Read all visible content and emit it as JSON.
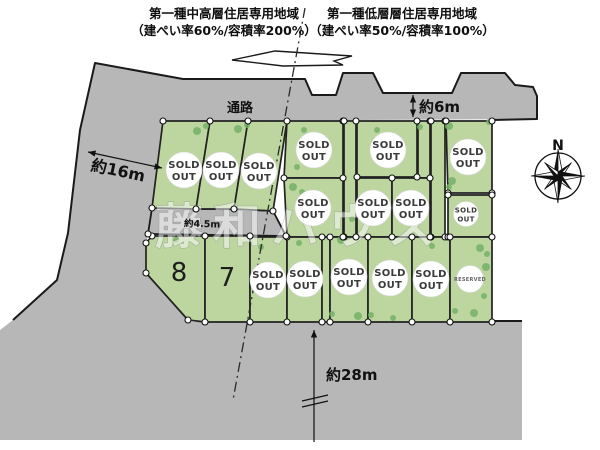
{
  "page": {
    "width": 600,
    "height": 450,
    "bg": "#ffffff"
  },
  "colors": {
    "road": "#b7b7b7",
    "lot": "#bdd6a0",
    "lot_edge": "#222222",
    "tree": "#74b267",
    "node_fill": "#ffffff",
    "node_edge": "#111111",
    "text": "#111111",
    "badge_fill": "#ffffff",
    "badge_text": "#3a3a3a",
    "reserved_text": "#666666",
    "watermark_fill": "#ffffff",
    "watermark_edge": "#7d828c",
    "dash": "#2a2a2a"
  },
  "zoning": {
    "left": {
      "line1": "第一種中高層住居専用地域",
      "line2": "（建ぺい率60%/容積率200%）"
    },
    "right": {
      "line1": "第一種低層層住居専用地域",
      "line2": "（建ぺい率50%/容積率100%）"
    },
    "boundary_line": {
      "x1": 305,
      "y1": 8,
      "x2": 233,
      "y2": 400
    }
  },
  "map": {
    "gray_area": [
      [
        95,
        63
      ],
      [
        183,
        79
      ],
      [
        305,
        79
      ],
      [
        312,
        95
      ],
      [
        336,
        95
      ],
      [
        343,
        73
      ],
      [
        373,
        73
      ],
      [
        383,
        93
      ],
      [
        452,
        93
      ],
      [
        461,
        73
      ],
      [
        505,
        73
      ],
      [
        515,
        85
      ],
      [
        533,
        87
      ],
      [
        537,
        96
      ],
      [
        537,
        119
      ],
      [
        163,
        121
      ],
      [
        152,
        208
      ],
      [
        148,
        234
      ],
      [
        146,
        243
      ],
      [
        146,
        273
      ],
      [
        188,
        320
      ],
      [
        188,
        322
      ],
      [
        492,
        322
      ],
      [
        522,
        322
      ],
      [
        522,
        440
      ],
      [
        0,
        440
      ],
      [
        0,
        330
      ],
      [
        13,
        320
      ],
      [
        57,
        280
      ],
      [
        68,
        233
      ],
      [
        80,
        130
      ]
    ],
    "road_mid": [
      [
        152,
        208
      ],
      [
        196,
        209
      ],
      [
        234,
        209
      ],
      [
        273,
        211
      ],
      [
        286,
        236
      ],
      [
        148,
        234
      ]
    ],
    "outlines": [
      "M13,320 L57,280 L68,233 L80,130 L95,63 L183,79 L305,79 L312,95 L336,95 L343,73 L373,73 L383,93 L452,93 L461,73 L505,73 L515,85 L533,87 L537,96 L537,119 L492,120",
      "M492,321 L522,321"
    ],
    "wedge": [
      [
        232,
        60
      ],
      [
        275,
        51
      ],
      [
        352,
        56
      ],
      [
        334,
        61
      ],
      [
        343,
        65
      ],
      [
        283,
        66
      ]
    ],
    "lots": [
      {
        "id": "u1",
        "points": [
          [
            163,
            121
          ],
          [
            210,
            121
          ],
          [
            196,
            209
          ],
          [
            152,
            208
          ]
        ],
        "badge": "sold",
        "badge_xy": [
          184,
          170
        ]
      },
      {
        "id": "u2",
        "points": [
          [
            210,
            121
          ],
          [
            248,
            121
          ],
          [
            234,
            209
          ],
          [
            196,
            209
          ]
        ],
        "badge": "sold",
        "badge_xy": [
          221,
          170
        ]
      },
      {
        "id": "u3",
        "points": [
          [
            248,
            121
          ],
          [
            287,
            121
          ],
          [
            273,
            211
          ],
          [
            234,
            209
          ]
        ],
        "badge": "sold",
        "badge_xy": [
          259,
          171
        ]
      },
      {
        "id": "a4",
        "points": [
          [
            287,
            121
          ],
          [
            343,
            121
          ],
          [
            343,
            178
          ],
          [
            284,
            178
          ]
        ],
        "badge": "sold",
        "badge_xy": [
          314,
          150
        ]
      },
      {
        "id": "p1",
        "points": [
          [
            344,
            121
          ],
          [
            356,
            121
          ],
          [
            356,
            237
          ],
          [
            344,
            237
          ]
        ]
      },
      {
        "id": "a5",
        "points": [
          [
            357,
            121
          ],
          [
            417,
            121
          ],
          [
            417,
            177
          ],
          [
            357,
            177
          ]
        ],
        "badge": "sold",
        "badge_xy": [
          388,
          150
        ]
      },
      {
        "id": "p2",
        "points": [
          [
            418,
            121
          ],
          [
            430,
            121
          ],
          [
            430,
            178
          ],
          [
            418,
            178
          ]
        ]
      },
      {
        "id": "p3",
        "points": [
          [
            431,
            121
          ],
          [
            445,
            121
          ],
          [
            445,
            237
          ],
          [
            431,
            237
          ]
        ]
      },
      {
        "id": "a6",
        "points": [
          [
            446,
            121
          ],
          [
            492,
            121
          ],
          [
            492,
            193
          ],
          [
            448,
            193
          ]
        ],
        "badge": "sold",
        "badge_xy": [
          468,
          157
        ]
      },
      {
        "id": "b1",
        "points": [
          [
            284,
            178
          ],
          [
            343,
            178
          ],
          [
            343,
            237
          ],
          [
            287,
            237
          ]
        ],
        "badge": "sold",
        "badge_xy": [
          313,
          208
        ]
      },
      {
        "id": "b2",
        "points": [
          [
            357,
            178
          ],
          [
            392,
            178
          ],
          [
            392,
            237
          ],
          [
            357,
            237
          ]
        ],
        "badge": "sold",
        "badge_xy": [
          373,
          208
        ]
      },
      {
        "id": "b3",
        "points": [
          [
            392,
            178
          ],
          [
            430,
            178
          ],
          [
            430,
            237
          ],
          [
            392,
            237
          ]
        ],
        "badge": "sold",
        "badge_xy": [
          411,
          208
        ]
      },
      {
        "id": "b4",
        "points": [
          [
            448,
            195
          ],
          [
            492,
            195
          ],
          [
            492,
            237
          ],
          [
            448,
            237
          ]
        ],
        "badge": "sold_small",
        "badge_xy": [
          466,
          214
        ]
      },
      {
        "id": "l8",
        "points": [
          [
            152,
            236
          ],
          [
            205,
            236
          ],
          [
            205,
            322
          ],
          [
            188,
            320
          ],
          [
            146,
            273
          ],
          [
            146,
            243
          ]
        ],
        "number": "8",
        "number_xy": [
          179,
          281
        ]
      },
      {
        "id": "l7",
        "points": [
          [
            205,
            236
          ],
          [
            250,
            236
          ],
          [
            250,
            322
          ],
          [
            205,
            322
          ]
        ],
        "number": "7",
        "number_xy": [
          227,
          286
        ]
      },
      {
        "id": "c1",
        "points": [
          [
            250,
            237
          ],
          [
            287,
            237
          ],
          [
            287,
            322
          ],
          [
            250,
            322
          ]
        ],
        "badge": "sold",
        "badge_xy": [
          268,
          280
        ]
      },
      {
        "id": "c2",
        "points": [
          [
            287,
            237
          ],
          [
            322,
            237
          ],
          [
            322,
            322
          ],
          [
            287,
            322
          ]
        ],
        "badge": "sold",
        "badge_xy": [
          305,
          279
        ]
      },
      {
        "id": "p4",
        "points": [
          [
            322,
            237
          ],
          [
            330,
            237
          ],
          [
            330,
            322
          ],
          [
            322,
            322
          ]
        ]
      },
      {
        "id": "c3",
        "points": [
          [
            330,
            237
          ],
          [
            368,
            237
          ],
          [
            368,
            322
          ],
          [
            330,
            322
          ]
        ],
        "badge": "sold",
        "badge_xy": [
          349,
          277
        ]
      },
      {
        "id": "c4",
        "points": [
          [
            368,
            237
          ],
          [
            412,
            237
          ],
          [
            412,
            322
          ],
          [
            368,
            322
          ]
        ],
        "badge": "sold",
        "badge_xy": [
          390,
          278
        ]
      },
      {
        "id": "c5",
        "points": [
          [
            412,
            237
          ],
          [
            450,
            237
          ],
          [
            450,
            322
          ],
          [
            412,
            322
          ]
        ],
        "badge": "sold",
        "badge_xy": [
          431,
          279
        ]
      },
      {
        "id": "c6",
        "points": [
          [
            450,
            237
          ],
          [
            492,
            237
          ],
          [
            492,
            322
          ],
          [
            450,
            322
          ]
        ],
        "badge": "reserved",
        "badge_xy": [
          470,
          279
        ]
      }
    ],
    "badges": {
      "sold": {
        "r": 18,
        "lines": [
          "SOLD",
          "OUT"
        ],
        "font": 10,
        "dy": [
          -2,
          10
        ]
      },
      "sold_small": {
        "r": 12.5,
        "lines": [
          "SOLD",
          "OUT"
        ],
        "font": 7,
        "dy": [
          -1.5,
          7.5
        ]
      },
      "reserved": {
        "r": 13.5,
        "lines": [
          "RESERVED"
        ],
        "font": 5,
        "dy": [
          2
        ]
      }
    },
    "trees": [
      [
        197,
        131,
        4
      ],
      [
        206,
        126,
        3
      ],
      [
        238,
        129,
        4
      ],
      [
        247,
        125,
        3
      ],
      [
        293,
        187,
        4
      ],
      [
        302,
        192,
        3
      ],
      [
        326,
        213,
        4
      ],
      [
        352,
        219,
        3
      ],
      [
        299,
        243,
        3
      ],
      [
        341,
        240,
        4
      ],
      [
        261,
        247,
        3
      ],
      [
        432,
        246,
        3
      ],
      [
        452,
        181,
        4
      ],
      [
        449,
        187,
        3
      ],
      [
        480,
        248,
        4
      ],
      [
        487,
        254,
        3
      ],
      [
        474,
        313,
        4
      ],
      [
        455,
        311,
        3
      ],
      [
        358,
        316,
        4
      ],
      [
        332,
        314,
        3
      ],
      [
        393,
        318,
        3
      ],
      [
        420,
        127,
        3
      ],
      [
        449,
        126,
        4
      ],
      [
        297,
        167,
        3
      ],
      [
        489,
        122,
        3
      ],
      [
        486,
        267,
        4
      ],
      [
        484,
        296,
        3
      ],
      [
        371,
        315,
        3
      ],
      [
        176,
        240,
        3
      ],
      [
        304,
        130,
        3
      ],
      [
        377,
        130,
        3
      ]
    ],
    "labels": [
      {
        "text": "通路",
        "x": 240,
        "y": 112,
        "size": 13,
        "rotate": 0,
        "weight": 600,
        "name": "passage-label"
      },
      {
        "text": "約4.5m",
        "x": 202,
        "y": 227,
        "size": 9.5,
        "rotate": 2,
        "weight": 600,
        "name": "road-width-mid-label"
      }
    ],
    "dims": {
      "d16": {
        "text": "約16m",
        "x1": 88,
        "y1": 152,
        "x2": 162,
        "y2": 168,
        "tx": 117,
        "ty": 176,
        "rotate": 12,
        "size": 16,
        "name": "frontage-16m"
      },
      "d6": {
        "text": "約6m",
        "x1": 413,
        "y1": 95,
        "x2": 413,
        "y2": 117,
        "tx": 419,
        "ty": 112,
        "size": 15,
        "name": "road-width-6m"
      },
      "d28": {
        "text": "約28m",
        "x": 314,
        "y1": 330,
        "y2": 442,
        "tx": 326,
        "ty": 380,
        "size": 15,
        "breaks": [
          [
            302,
            401,
            328,
            395
          ],
          [
            302,
            407,
            328,
            401
          ]
        ],
        "name": "depth-28m"
      }
    },
    "compass": {
      "cx": 558,
      "cy": 176,
      "ring_r": 23,
      "r_main": 27,
      "r_diag": 19,
      "label": "N",
      "lx": 558,
      "ly": 150
    },
    "watermark": {
      "text": "藤和ハウス",
      "x": 300,
      "y": 243,
      "size": 48,
      "spacing": 10
    }
  }
}
